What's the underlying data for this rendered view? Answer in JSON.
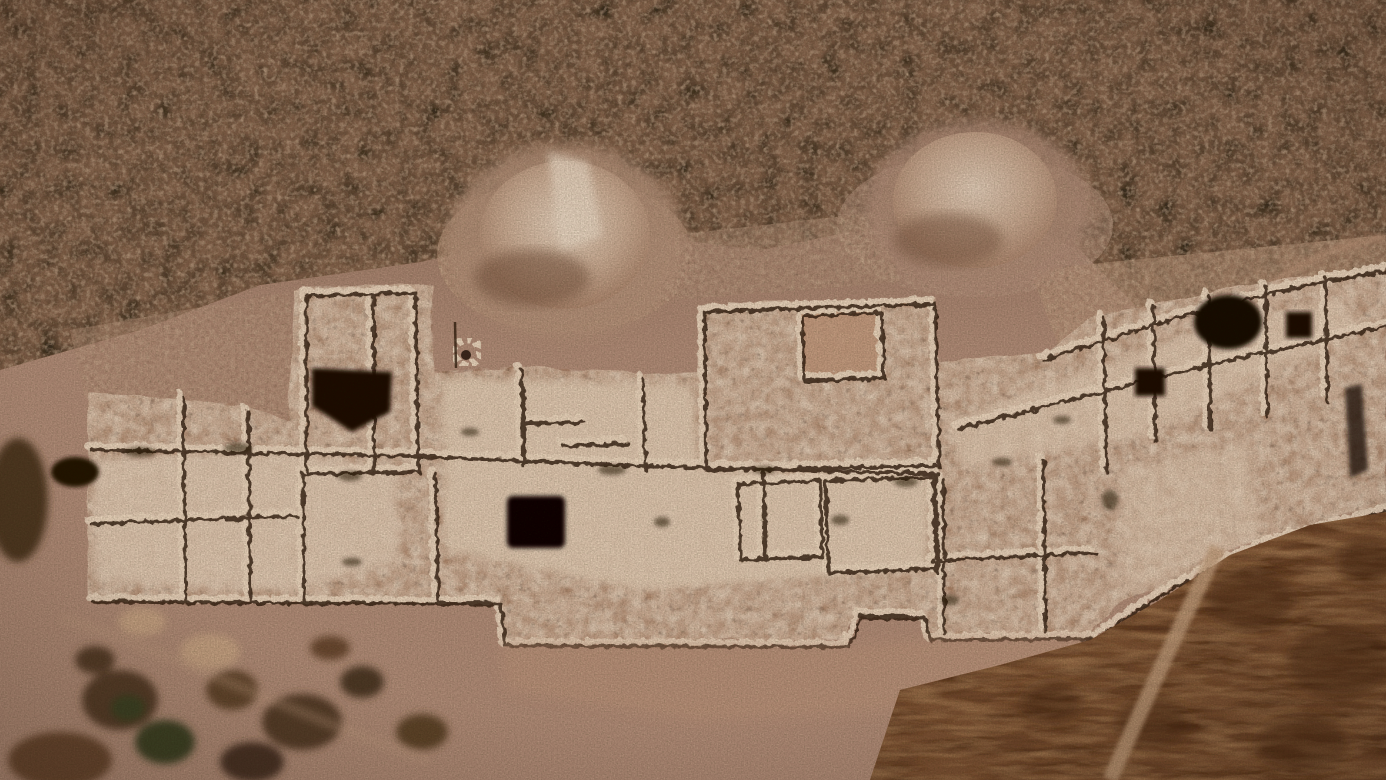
{
  "scene": {
    "description": "Aerial drone photograph of an archaeological excavation: rectangular stone-wall foundations of ancient rooms exposed in a long trench cut across a scrub-covered hillside, with light spoil mounds above the trench, a dark cistern opening in the pale bedrock, patchy vegetation at lower left and dry brown grass with a worn footpath at lower right.",
    "type": "aerial-photograph"
  },
  "palette": {
    "soil_top": "#8b6b56",
    "soil_mid": "#b3907a",
    "soil_light": "#c2a086",
    "soil_apron": "#c09a7e",
    "scrub_base": "#87684f",
    "scrub_bush": "#3e3320",
    "scrub_rock": "#c7ab8d",
    "mound_highlight": "#e8d6c0",
    "mound_core": "#cdb096",
    "mound_edge": "#a9846a",
    "mound_shadow": "#7d5b44",
    "excavation_base": "#d3b79e",
    "excavation_bright": "#e4cfb6",
    "wall_stone": "#ecd9bf",
    "wall_shadow": "#2e1b0c",
    "pit_dark": "#1c0f06",
    "hole_black": "#0a0603",
    "veg_dark": "#57402a",
    "veg_green": "#3c4527",
    "grass_base": "#7d5434",
    "grass_dark": "#4e2e18",
    "path_light": "#c4a27f",
    "vignette": "#1e0f05"
  }
}
